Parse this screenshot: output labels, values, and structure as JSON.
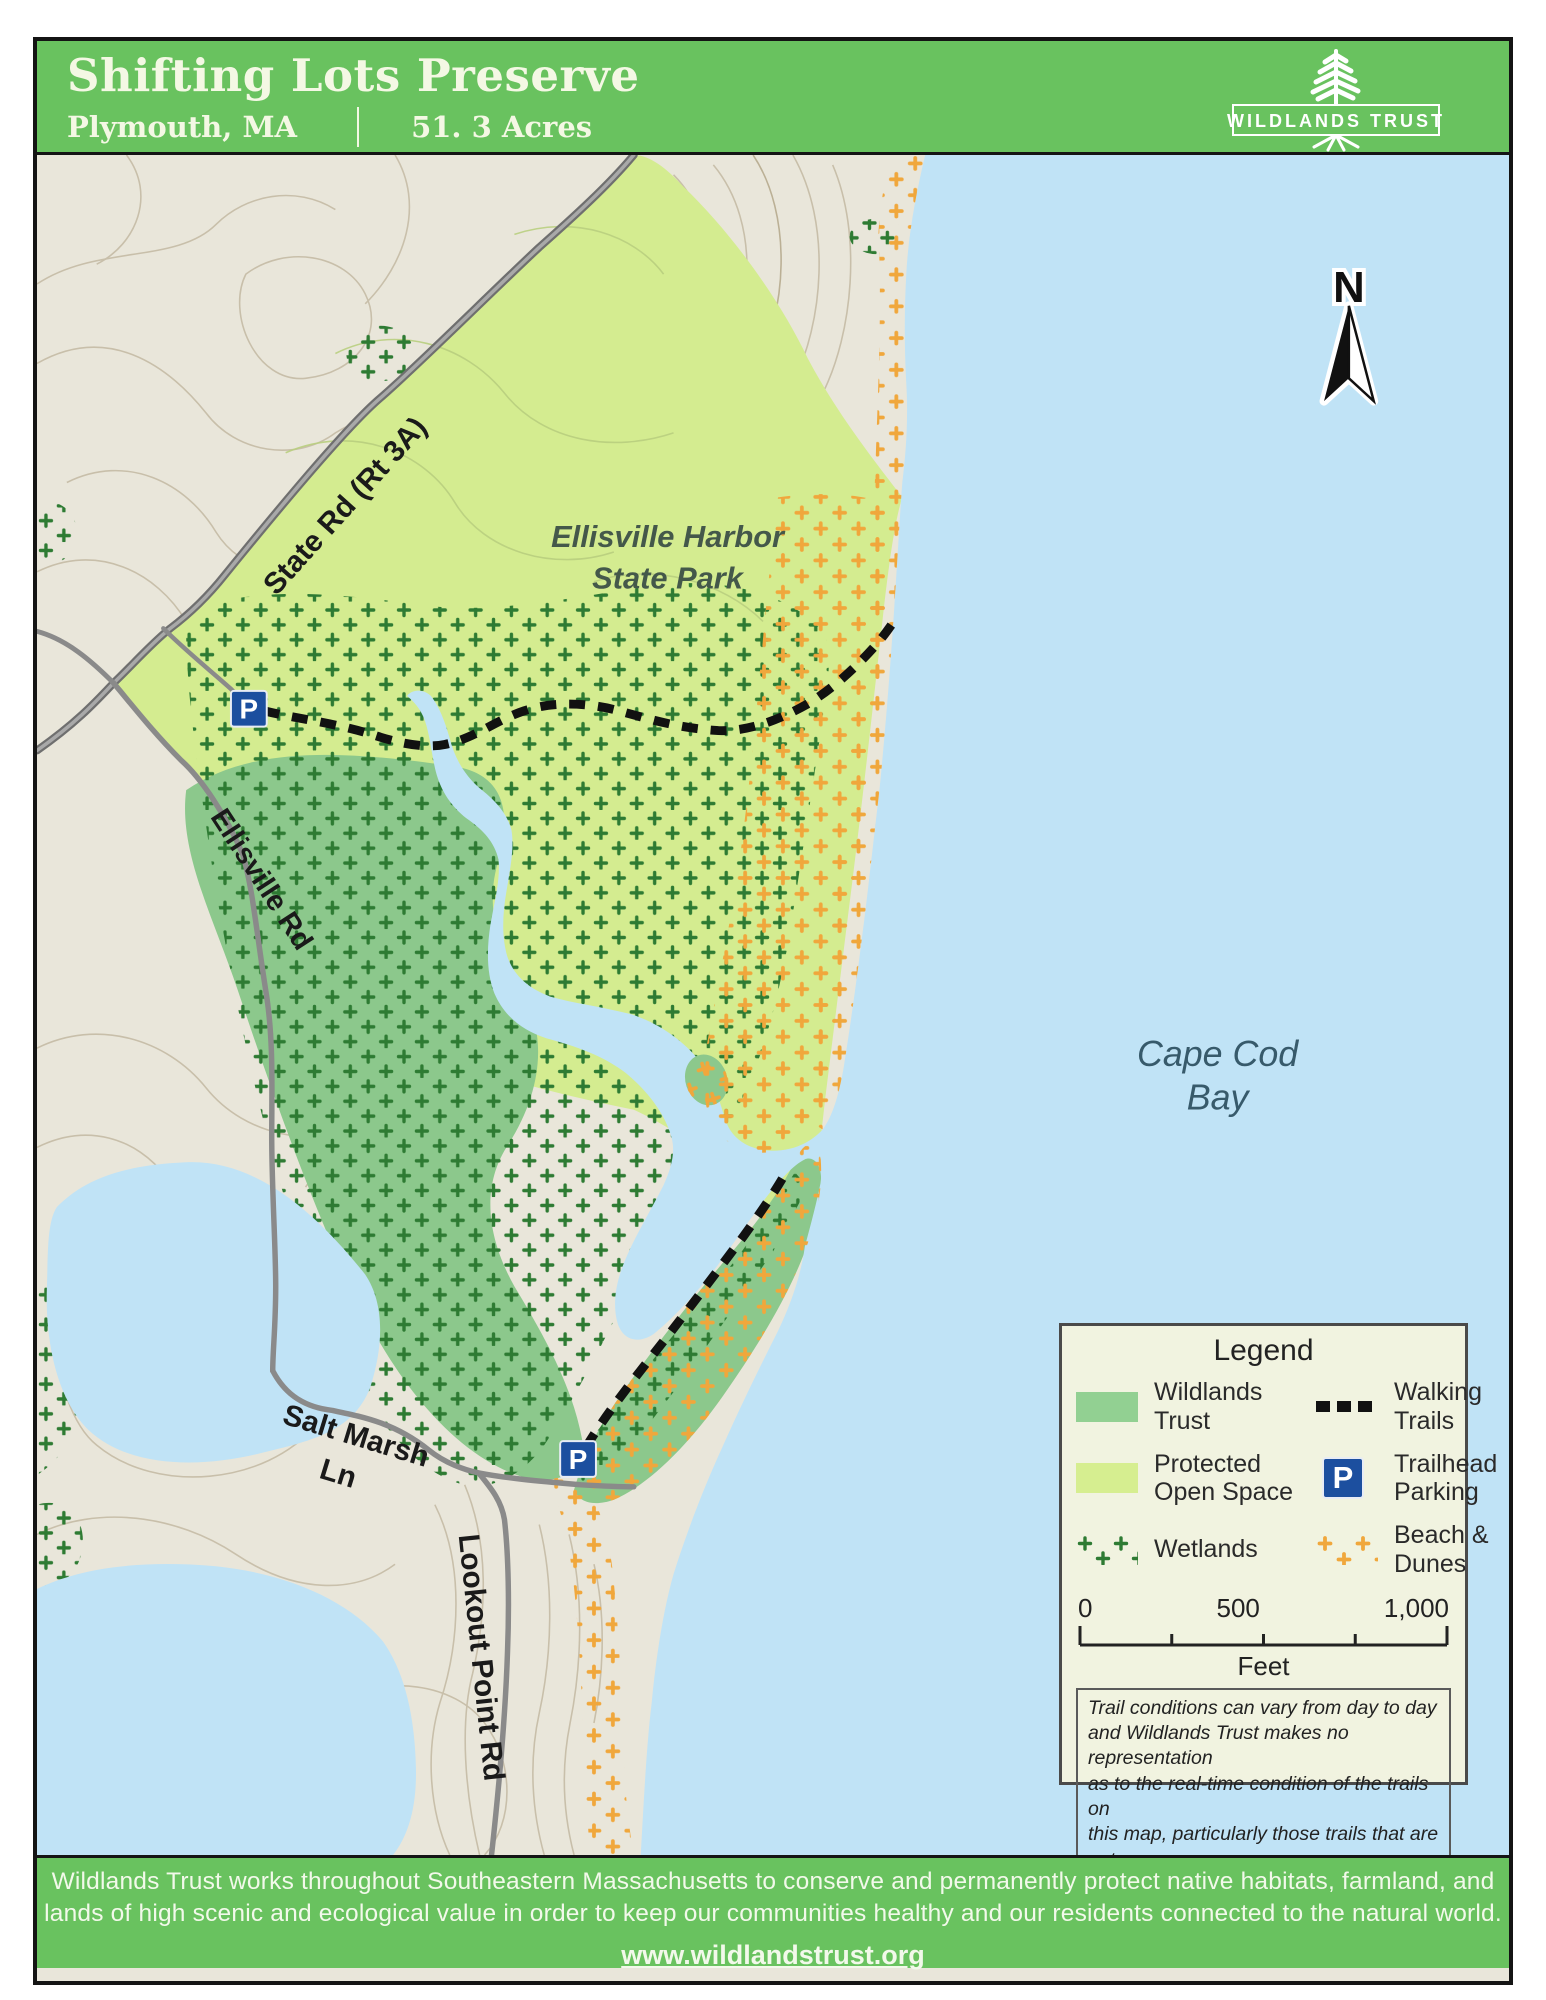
{
  "header": {
    "title": "Shifting Lots Preserve",
    "location": "Plymouth, MA",
    "acreage": "51. 3 Acres",
    "logo_text": "Wildlands Trust"
  },
  "map": {
    "labels": {
      "state_rd": "State Rd (Rt 3A)",
      "ellisville_rd": "Ellisville Rd",
      "salt_marsh_1": "Salt Marsh",
      "salt_marsh_2": "Ln",
      "lookout_rd": "Lookout Point Rd",
      "park_1": "Ellisville Harbor",
      "park_2": "State Park",
      "bay_1": "Cape Cod",
      "bay_2": "Bay",
      "north": "N",
      "parking": "P"
    },
    "colors": {
      "header_green": "#69c25f",
      "terrain": "#e9e6da",
      "protected_open_space": "#d4ec90",
      "wildlands_trust": "#8cc88c",
      "water": "#c0e3f6",
      "wetland_dot": "#2e7b33",
      "dune_dot": "#f0a73c",
      "parking_blue": "#1c4f9f",
      "trail_black": "#111111"
    }
  },
  "legend": {
    "title": "Legend",
    "items": {
      "wildlands": {
        "line1": "Wildlands",
        "line2": "Trust"
      },
      "walking": {
        "line1": "Walking",
        "line2": "Trails"
      },
      "protected": {
        "line1": "Protected",
        "line2": "Open Space"
      },
      "trailhead": {
        "line1": "Trailhead",
        "line2": "Parking"
      },
      "wetlands": {
        "line1": "Wetlands",
        "line2": ""
      },
      "dunes": {
        "line1": "Beach &",
        "line2": "Dunes"
      }
    },
    "scale": {
      "t0": "0",
      "t500": "500",
      "t1000": "1,000",
      "unit": "Feet"
    },
    "disclaimer": [
      "Trail conditions can vary from day to day",
      "and Wildlands Trust makes no representation",
      "as to the real-time condition of the trails on",
      "this map, particularly those trails that are not",
      "on Wildlands properties."
    ]
  },
  "footer": {
    "line1": "Wildlands Trust works throughout Southeastern Massachusetts to conserve and permanently protect native habitats, farmland, and",
    "line2": "lands of high scenic and ecological value in order to keep our communities healthy and our residents connected to the natural world.",
    "website": "www.wildlandstrust.org"
  }
}
